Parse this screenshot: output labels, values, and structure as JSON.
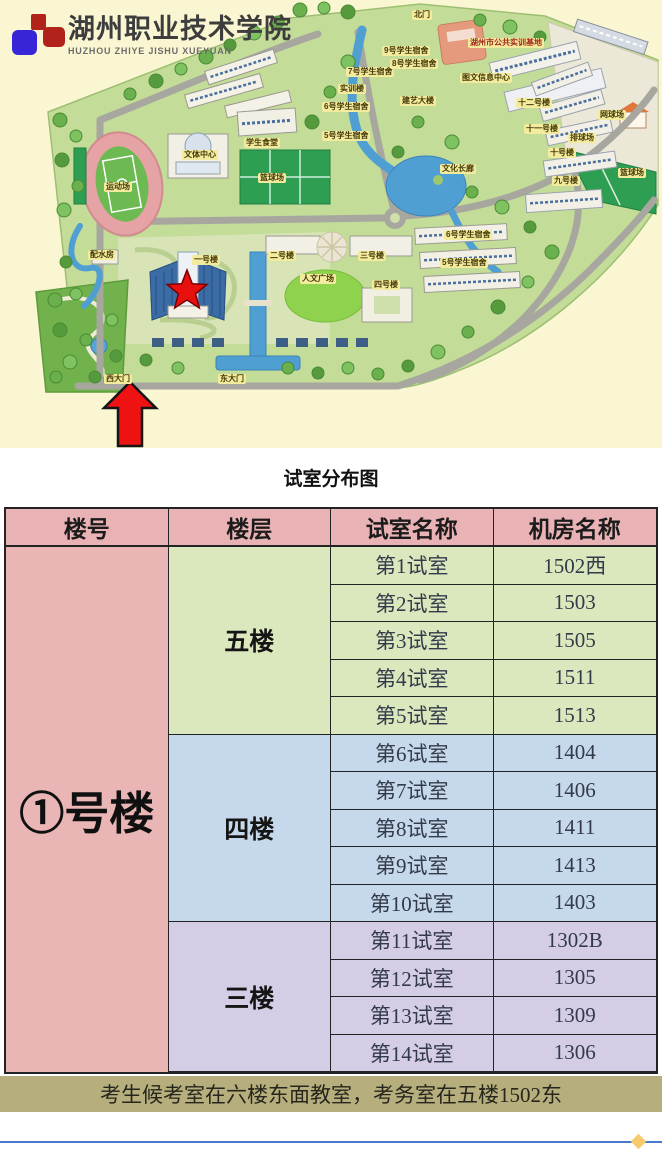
{
  "logo": {
    "school_name_cn": "湖州职业技术学院",
    "school_name_pinyin": "HUZHOU ZHIYE JISHU XUEYUAN"
  },
  "map": {
    "labels": [
      {
        "text": "北门"
      },
      {
        "text": "湖州市公共实训基地"
      },
      {
        "text": "9号学生宿舍"
      },
      {
        "text": "8号学生宿舍"
      },
      {
        "text": "7号学生宿舍"
      },
      {
        "text": "实训楼"
      },
      {
        "text": "图文信息中心"
      },
      {
        "text": "建艺大楼"
      },
      {
        "text": "6号学生宿舍"
      },
      {
        "text": "5号学生宿舍"
      },
      {
        "text": "十二号楼"
      },
      {
        "text": "网球场"
      },
      {
        "text": "十一号楼"
      },
      {
        "text": "排球场"
      },
      {
        "text": "十号楼"
      },
      {
        "text": "九号楼"
      },
      {
        "text": "篮球场"
      },
      {
        "text": "学生食堂"
      },
      {
        "text": "文体中心"
      },
      {
        "text": "篮球场"
      },
      {
        "text": "运动场"
      },
      {
        "text": "文化长廊"
      },
      {
        "text": "一号楼"
      },
      {
        "text": "二号楼"
      },
      {
        "text": "三号楼"
      },
      {
        "text": "人文广场"
      },
      {
        "text": "四号楼"
      },
      {
        "text": "6号学生宿舍"
      },
      {
        "text": "5号学生宿舍"
      },
      {
        "text": "配水房"
      },
      {
        "text": "西大门"
      },
      {
        "text": "东大门"
      }
    ]
  },
  "figure_title": "试室分布图",
  "table": {
    "headers": [
      "楼号",
      "楼层",
      "试室名称",
      "机房名称"
    ],
    "building": "①号楼",
    "sections": [
      {
        "floor": "五楼",
        "rows": [
          {
            "room": "第1试室",
            "lab": "1502西"
          },
          {
            "room": "第2试室",
            "lab": "1503"
          },
          {
            "room": "第3试室",
            "lab": "1505"
          },
          {
            "room": "第4试室",
            "lab": "1511"
          },
          {
            "room": "第5试室",
            "lab": "1513"
          }
        ]
      },
      {
        "floor": "四楼",
        "rows": [
          {
            "room": "第6试室",
            "lab": "1404"
          },
          {
            "room": "第7试室",
            "lab": "1406"
          },
          {
            "room": "第8试室",
            "lab": "1411"
          },
          {
            "room": "第9试室",
            "lab": "1413"
          },
          {
            "room": "第10试室",
            "lab": "1403"
          }
        ]
      },
      {
        "floor": "三楼",
        "rows": [
          {
            "room": "第11试室",
            "lab": "1302B"
          },
          {
            "room": "第12试室",
            "lab": "1305"
          },
          {
            "room": "第13试室",
            "lab": "1309"
          },
          {
            "room": "第14试室",
            "lab": "1306"
          }
        ]
      }
    ],
    "note": "考生候考室在六楼东面教室，考务室在五楼1502东"
  },
  "colors": {
    "map_background": "#faf6d2",
    "header_bg": "#e9b2b5",
    "building_bg": "#eab5b5",
    "floor5_bg": "#dbe7bd",
    "floor4_bg": "#c6d9ec",
    "floor3_bg": "#d4cde5",
    "note_bg": "#b6ae7d",
    "divider_line": "#4a79cc",
    "divider_diamond": "#f7cb6b",
    "star_red": "#e80f0f",
    "arrow_red": "#ee1212"
  }
}
